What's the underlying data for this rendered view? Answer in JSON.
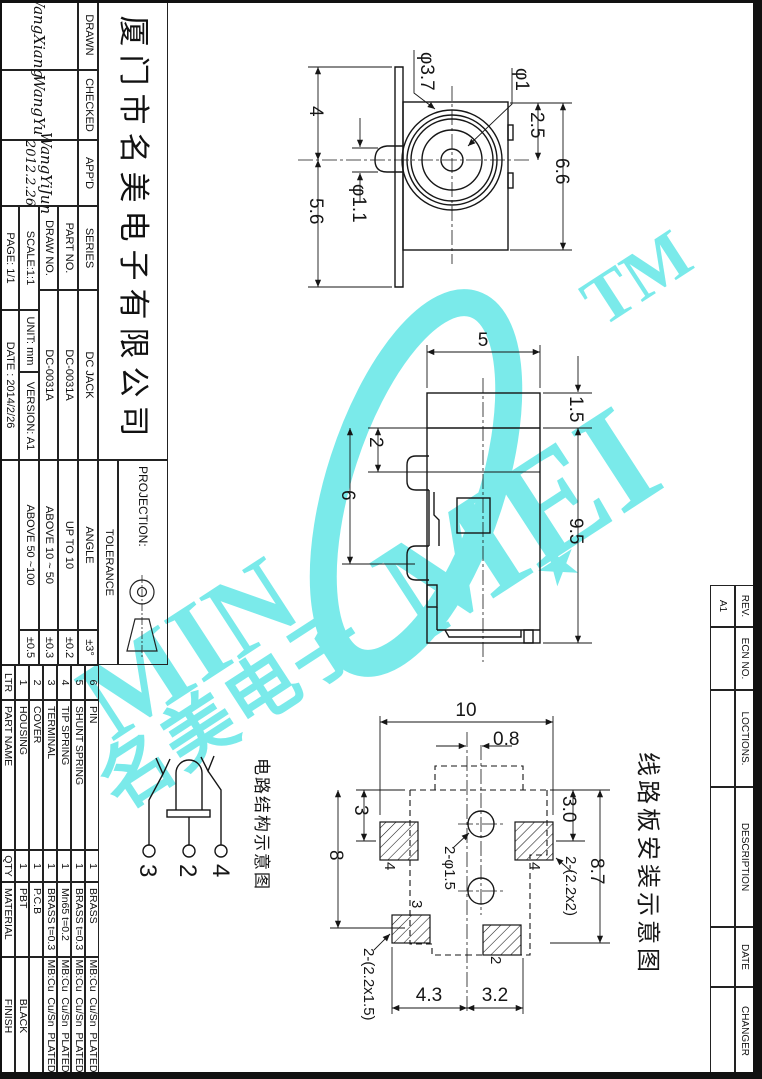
{
  "title_block": {
    "company": "厦门市名美电子有限公司",
    "drawn_label": "DRAWN",
    "drawn_signature": "WangXiang",
    "checked_label": "CHECKED",
    "checked_signature": "WangYu",
    "approved_label": "APP'D",
    "approved_signature": "WangYiJun",
    "approved_date": "2012.2.26",
    "series_label": "SERIES",
    "series_value": "DC JACK",
    "part_no_label": "PART NO.",
    "part_no_value": "DC-0031A",
    "draw_no_label": "DRAW NO.",
    "draw_no_value": "DC-0031A",
    "scale_label": "SCALE:1:1",
    "unit_label": "UNIT: mm",
    "version_label": "VERSION: A1",
    "page_label": "PAGE: 1/1",
    "date_label": "DATE : 2014/2/26",
    "projection_label": "PROJECTION:",
    "tolerance_label": "TOLERANCE",
    "angle_label": "ANGLE",
    "angle_value": "±3°",
    "tol_rows": [
      {
        "range": "UP TO 10",
        "value": "±0.2"
      },
      {
        "range": "ABOVE 10 ~ 50",
        "value": "±0.3"
      },
      {
        "range": "ABOVE 50 ~100",
        "value": "±0.5"
      }
    ]
  },
  "parts_table": {
    "headers": {
      "ltr": "LTR",
      "part_name": "PART NAME",
      "qty": "QTY",
      "material": "MATERIAL",
      "finish": "FINISH"
    },
    "rows": [
      {
        "ltr": "6",
        "part_name": "PIN",
        "qty": "1",
        "material": "BRASS",
        "finish": "MB:Cu  Cu/Sn  PLATED"
      },
      {
        "ltr": "5",
        "part_name": "SHUNT SPRING",
        "qty": "1",
        "material": "BRASS t=0.3",
        "finish": "MB:Cu  Cu/Sn  PLATED"
      },
      {
        "ltr": "4",
        "part_name": "TIP SPRING",
        "qty": "1",
        "material": "Mn65 t=0.2",
        "finish": "MB:Cu  Cu/Sn  PLATED"
      },
      {
        "ltr": "3",
        "part_name": "TERMINAL",
        "qty": "1",
        "material": "BRASS t=0.3",
        "finish": "MB:Cu  Cu/Sn  PLATED"
      },
      {
        "ltr": "2",
        "part_name": "COVER",
        "qty": "1",
        "material": "P.C.B",
        "finish": ""
      },
      {
        "ltr": "1",
        "part_name": "HOUSING",
        "qty": "1",
        "material": "PBT",
        "finish": "BLACK"
      }
    ]
  },
  "revision_strip": {
    "rev_label": "REV.",
    "rev_value": "A1",
    "ecn_label": "ECN NO.",
    "locations_label": "LOCTIONS.",
    "description_label": "DESCRIPTION",
    "date_label": "DATE",
    "changer_label": "CHANGER"
  },
  "front_view": {
    "dia_outer": "φ3.7",
    "dia_pin": "φ1",
    "dim_top": "2.5",
    "dim_height": "6.6",
    "dim_upper": "4",
    "dim_lower": "5.6",
    "dia_shaft": "φ1.1"
  },
  "side_view": {
    "dim_width": "5",
    "dim_top": "1.5",
    "dim_body": "9.5",
    "dim_tab": "2",
    "dim_pitch": "6"
  },
  "pcb_view": {
    "caption": "线路板安装示意图",
    "dim_width": "10",
    "dim_offset": "0.8",
    "dim_pad_top": "3",
    "dim_left": "8",
    "dim_right_top": "3.0",
    "dim_right": "8.7",
    "pads_side": "2-(2.2x2)",
    "holes": "2-φ1.5",
    "pads_bottom": "2-(2.2x1.5)",
    "dim_bottom_left": "4.3",
    "dim_bottom_right": "3.2",
    "pad_label_tl": "4",
    "pad_label_tr": "4",
    "pad_label_bl": "3",
    "pad_label_br": "2"
  },
  "circuit": {
    "caption": "电路结构示意图",
    "terminal_left": "3",
    "terminal_center": "2",
    "terminal_right": "4"
  },
  "watermark": {
    "text_min": "MIN",
    "text_mei": "MEI",
    "text_tm": "TM",
    "text_cn": "名美电子",
    "star": "★",
    "color": "#6FE9E9"
  }
}
